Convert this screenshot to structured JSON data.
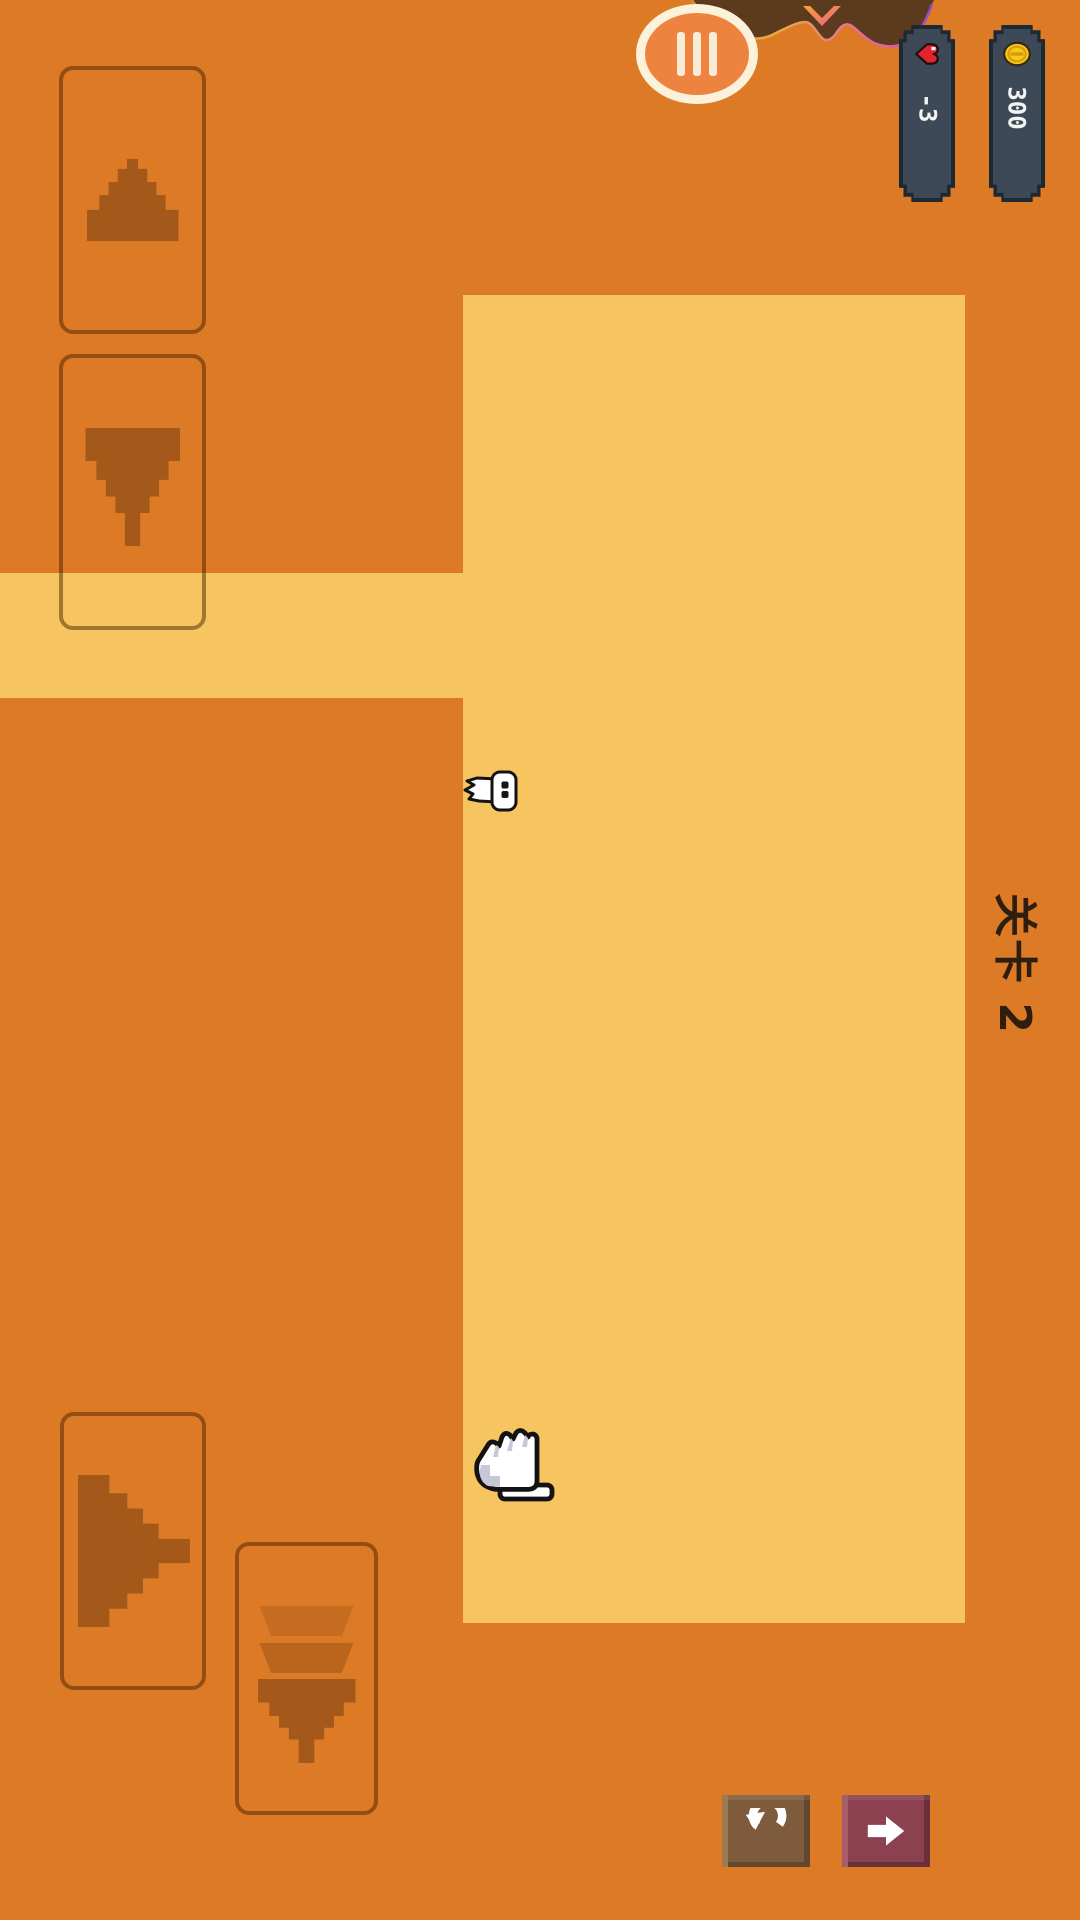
{
  "hud": {
    "pause_button": {
      "icon": "pause-bars"
    },
    "lives": {
      "icon": "heart",
      "value": "-3"
    },
    "coins": {
      "icon": "coin",
      "value": "300"
    }
  },
  "level": {
    "label": "关卡 2"
  },
  "controls": {
    "up": {
      "icon": "triangle-up"
    },
    "down": {
      "icon": "triangle-down"
    },
    "right": {
      "icon": "triangle-right"
    },
    "drop": {
      "icon": "triple-chevron-down"
    },
    "restart": {
      "icon": "undo-arrow"
    },
    "next": {
      "icon": "arrow-right"
    }
  },
  "sprites": {
    "character": "white-bird-sprite",
    "hand": "hand-cursor-sprite"
  },
  "decoration": {
    "banner": "brown-wave-banner",
    "chevron": "gradient-chevron-down"
  },
  "colors": {
    "background": "#DC7A26",
    "board": "#F6C55F",
    "triangle": "#A4581A",
    "banner_brown": "#5C3A1E",
    "badge_face": "#3D4956",
    "badge_rim": "#1E2933",
    "pause_fill": "#EE8340",
    "pause_ring": "#FCF1DB",
    "heart_red": "#E3242E",
    "coin_gold": "#F7C90F",
    "restart_brown": "#7D5B3C",
    "next_maroon": "#8C4150",
    "level_text": "#2E1E10"
  }
}
